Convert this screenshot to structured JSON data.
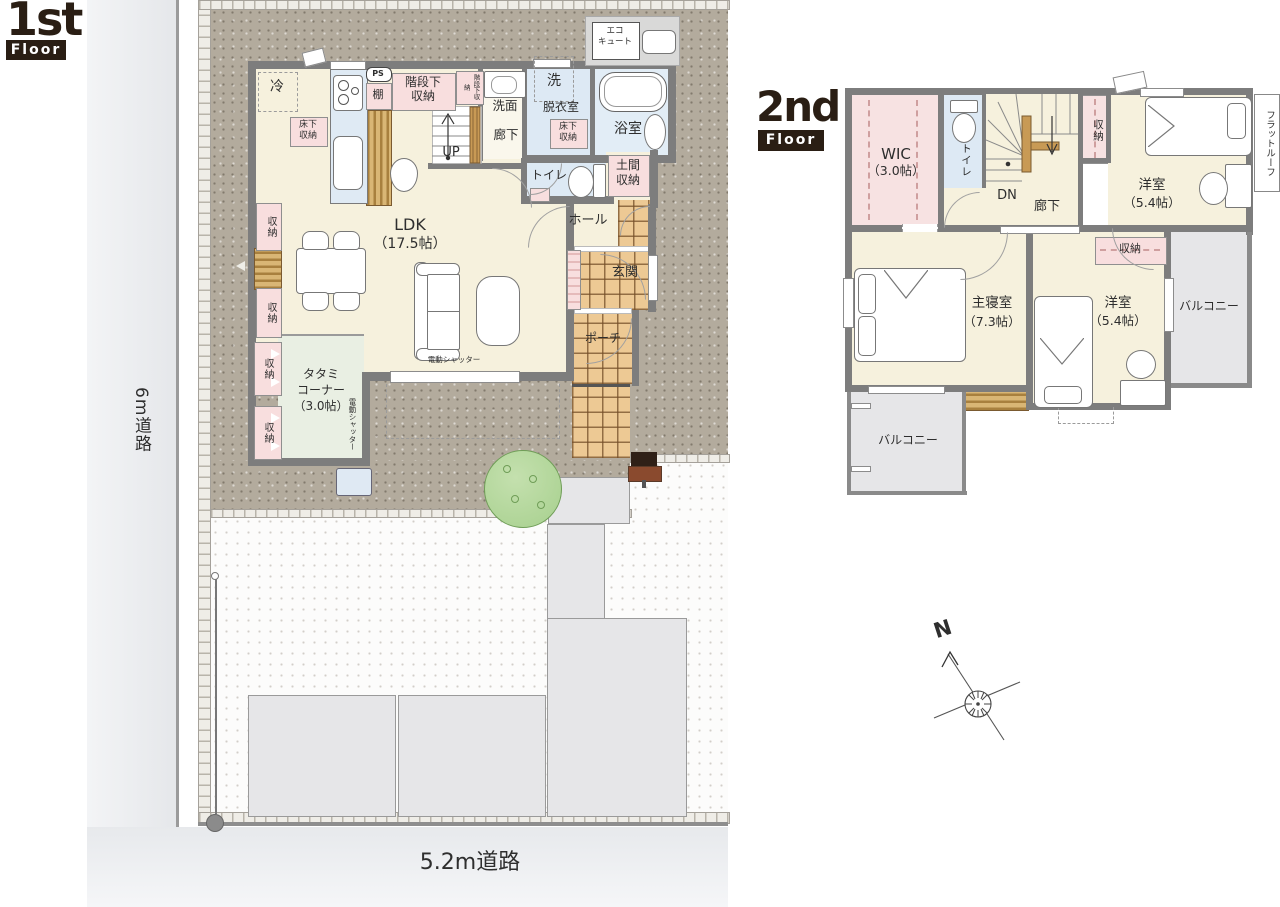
{
  "badges": {
    "f1_num": "1st",
    "f1_word": "Floor",
    "f2_num": "2nd",
    "f2_word": "Floor"
  },
  "roads": {
    "left": "6m道路",
    "bottom": "5.2m道路"
  },
  "f1": {
    "ldk": "LDK",
    "ldk_size": "（17.5帖）",
    "tatami_l1": "タタミ",
    "tatami_l2": "コーナー",
    "tatami_l3": "（3.0帖）",
    "hall": "ホール",
    "genkan": "玄関",
    "porch": "ポーチ",
    "corridor": "廊下",
    "up": "UP",
    "washroom": "洗面",
    "dressing": "脱衣室",
    "wash": "洗",
    "bath": "浴室",
    "toilet": "トイレ",
    "fridge": "冷",
    "ps": "PS",
    "shelf": "棚",
    "understair_l1": "階段下",
    "understair_l2": "収納",
    "understair_small": "階段下収納",
    "underfloor_l1": "床下",
    "underfloor_l2": "収納",
    "doma_l1": "土間",
    "doma_l2": "収納",
    "storage": "収納",
    "eco_l1": "エコ",
    "eco_l2": "キュート",
    "shutter": "電動シャッター"
  },
  "f2": {
    "wic": "WIC",
    "wic_size": "（3.0帖）",
    "toilet": "トイレ",
    "dn": "DN",
    "corridor": "廊下",
    "storage": "収納",
    "room_a": "洋室",
    "room_a_size": "（5.4帖）",
    "master": "主寝室",
    "master_size": "（7.3帖）",
    "room_b": "洋室",
    "room_b_size": "（5.4帖）",
    "balcony_r": "バルコニー",
    "balcony_l": "バルコニー",
    "flat_roof": "フラットルーフ"
  },
  "compass": {
    "n": "N"
  },
  "colors": {
    "wall": "#7d7d7d",
    "floor": "#f6f1dd",
    "wet": "#dde9f4",
    "tatami_floor": "#e9efe3",
    "closet_pink": "#f8dede",
    "tile": "#edc994",
    "balcony": "#e6e6e8",
    "ground": "#b3ab9d",
    "wood": "#c89a55"
  }
}
